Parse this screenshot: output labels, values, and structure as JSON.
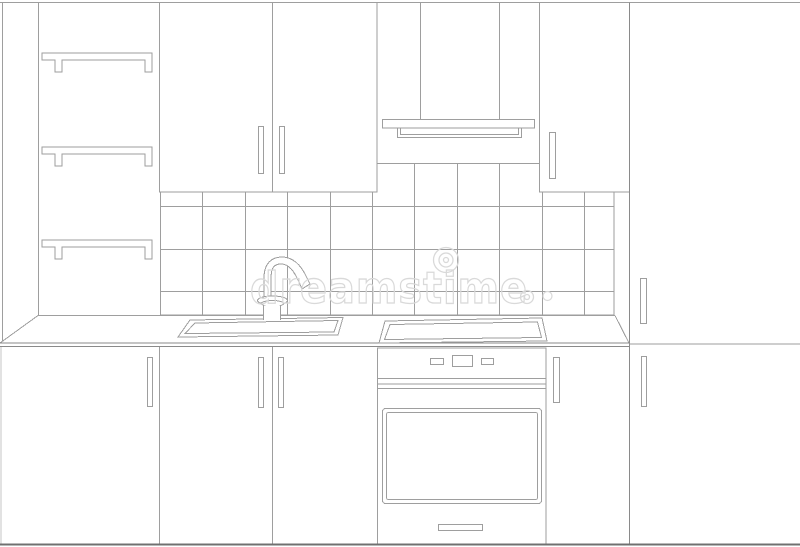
{
  "title": "Black and white sketch line drawing of a kitchen furniture set, front view",
  "watermark": {
    "text": "dreamstime"
  },
  "colors": {
    "background": "#ffffff",
    "line": "#9e9e9e",
    "lineStrong": "#8a8a8a",
    "lineDark": "#707070",
    "watermark": "#d9d9d9"
  },
  "scene": {
    "elements": [
      "three wall shelves with brackets",
      "double-door wall cabinet with two handles",
      "cooker hood with chimney",
      "single-door wall cabinet",
      "tiled backsplash grid",
      "countertop in perspective",
      "inset sink with gooseneck faucet",
      "cooktop panel",
      "built-in oven with control panel, glass door and drawer",
      "four base cabinet doors with handles",
      "tall cabinet on the right with two handles"
    ]
  }
}
